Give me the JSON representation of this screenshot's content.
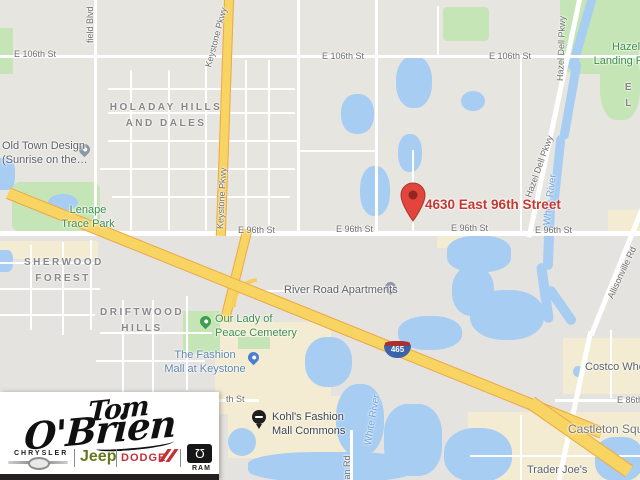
{
  "map": {
    "neighborhoods": {
      "holaday": "HOLADAY HILLS\nAND DALES",
      "sherwood": "SHERWOOD\nFOREST",
      "driftwood": "DRIFTWOOD\nHILLS",
      "partial_el": "E L"
    },
    "streets": {
      "e_106th": "E 106th St",
      "e_96th": "E 96th St",
      "e_86th": "E 86th St",
      "partial_th_st": "th St",
      "westfield_blvd_partial": "field Blvd",
      "keystone_pkwy": "Keystone Pkwy",
      "hazel_dell_pkwy": "Hazel Dell Pkwy",
      "allisonville_rd": "Allisonville Rd",
      "dean_rd": "Dean Rd"
    },
    "water_labels": {
      "white_river": "White River"
    },
    "pois": {
      "old_town_design": "Old Town Design\n(Sunrise on the…",
      "lenape_trace_park": "Lenape\nTrace Park",
      "hazel_landing_park": "Hazel\nLanding Park",
      "our_lady_of_peace": "Our Lady of\nPeace Cemetery",
      "river_road_apartments": "River Road Apartments",
      "fashion_mall": "The Fashion\nMall at Keystone",
      "kohls_commons": "Kohl's Fashion\nMall Commons",
      "costco": "Costco Wholesale",
      "castleton_square": "Castleton Square",
      "trader_joes": "Trader Joe's"
    },
    "marker": {
      "address": "4630 East 96th Street"
    },
    "shield": {
      "number": "465"
    }
  },
  "logo": {
    "name_line1": "Tom",
    "name_line2": "O'Brien",
    "chrysler": "CHRYSLER",
    "jeep": "Jeep",
    "dodge": "DODGE",
    "ram": "RAM"
  },
  "colors": {
    "water": "#a7cdf3",
    "park": "#c5e5b6",
    "commercial": "#f3ecd2",
    "highway": "#f8d463",
    "marker_red": "#e2453c",
    "address_red": "#c63832",
    "park_label_green": "#3d8e47",
    "jeep_green": "#66771c",
    "dodge_red": "#c62f34"
  }
}
